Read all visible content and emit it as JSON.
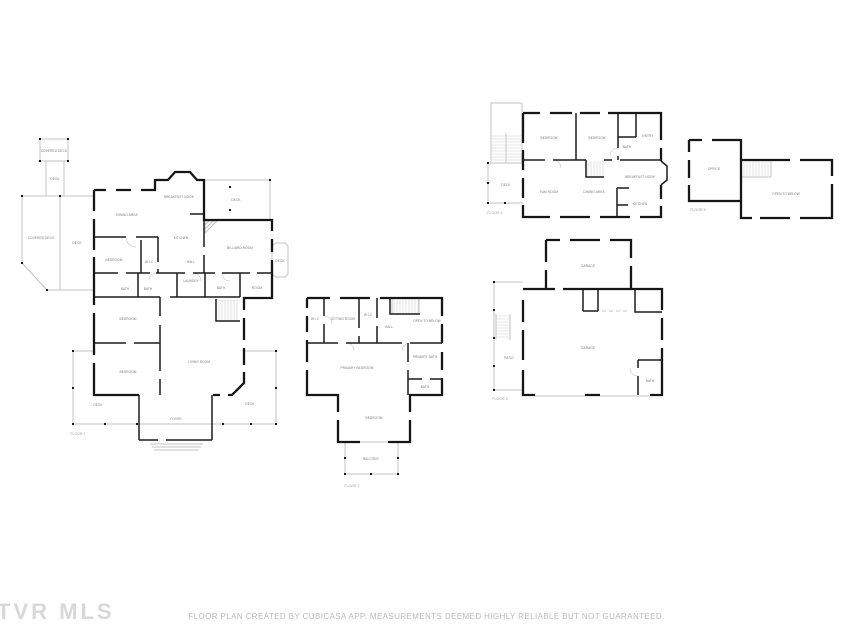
{
  "watermark": {
    "text": "TVR MLS"
  },
  "disclaimer": {
    "text": "FLOOR PLAN CREATED BY CUBICASA APP. MEASUREMENTS DEEMED HIGHLY RELIABLE BUT NOT GUARANTEED."
  },
  "colors": {
    "background": "#ffffff",
    "wall": "#161616",
    "deck_line": "#c3c3c3",
    "room_label": "#787878",
    "floor_label": "#9a9a9a",
    "watermark": "#d8d8d8",
    "disclaimer": "#b9b9b9"
  },
  "floors": [
    {
      "id": "floor-1",
      "title": "FLOOR 1",
      "title_x": 78,
      "title_y": 435,
      "labels": [
        {
          "text": "COVERED DECK",
          "x": 54,
          "y": 152
        },
        {
          "text": "DECK",
          "x": 55,
          "y": 180
        },
        {
          "text": "COVERED DECK",
          "x": 41,
          "y": 239
        },
        {
          "text": "DECK",
          "x": 77,
          "y": 244
        },
        {
          "text": "DINING AREA",
          "x": 127,
          "y": 216
        },
        {
          "text": "BREAKFAST NOOK",
          "x": 179,
          "y": 198
        },
        {
          "text": "DECK",
          "x": 236,
          "y": 201
        },
        {
          "text": "KITCHEN",
          "x": 181,
          "y": 239
        },
        {
          "text": "BILLIARD ROOM",
          "x": 240,
          "y": 249
        },
        {
          "text": "DECK",
          "x": 280,
          "y": 262
        },
        {
          "text": "BEDROOM",
          "x": 114,
          "y": 261
        },
        {
          "text": "W.I.C",
          "x": 149,
          "y": 263
        },
        {
          "text": "HALL",
          "x": 191,
          "y": 263
        },
        {
          "text": "LAUNDRY",
          "x": 191,
          "y": 282
        },
        {
          "text": "BATH",
          "x": 125,
          "y": 290
        },
        {
          "text": "BATH",
          "x": 148,
          "y": 290
        },
        {
          "text": "BATH",
          "x": 221,
          "y": 289
        },
        {
          "text": "ROOM",
          "x": 257,
          "y": 289
        },
        {
          "text": "BEDROOM",
          "x": 128,
          "y": 320
        },
        {
          "text": "LIVING ROOM",
          "x": 199,
          "y": 363
        },
        {
          "text": "BEDROOM",
          "x": 128,
          "y": 373
        },
        {
          "text": "DECK",
          "x": 98,
          "y": 406
        },
        {
          "text": "DECK",
          "x": 250,
          "y": 405
        },
        {
          "text": "FOYER",
          "x": 176,
          "y": 420
        }
      ]
    },
    {
      "id": "floor-2",
      "title": "FLOOR 2",
      "title_x": 352,
      "title_y": 487,
      "labels": [
        {
          "text": "W.I.C",
          "x": 315,
          "y": 320
        },
        {
          "text": "SITTING ROOM",
          "x": 343,
          "y": 320
        },
        {
          "text": "W.I.C",
          "x": 368,
          "y": 316
        },
        {
          "text": "HALL",
          "x": 389,
          "y": 328
        },
        {
          "text": "OPEN TO BELOW",
          "x": 427,
          "y": 322
        },
        {
          "text": "PRIMARY BATH",
          "x": 425,
          "y": 358
        },
        {
          "text": "PRIMARY BEDROOM",
          "x": 357,
          "y": 369
        },
        {
          "text": "BATH",
          "x": 425,
          "y": 388
        },
        {
          "text": "BEDROOM",
          "x": 374,
          "y": 419
        },
        {
          "text": "BALCONY",
          "x": 371,
          "y": 460
        }
      ]
    },
    {
      "id": "floor-3",
      "title": "FLOOR 3",
      "title_x": 500,
      "title_y": 400,
      "labels": [
        {
          "text": "GARAGE",
          "x": 588,
          "y": 267
        },
        {
          "text": "GARAGE",
          "x": 588,
          "y": 349
        },
        {
          "text": "PATIO",
          "x": 509,
          "y": 359
        },
        {
          "text": "BATH",
          "x": 650,
          "y": 382
        }
      ]
    },
    {
      "id": "floor-4",
      "title": "FLOOR 4",
      "title_x": 495,
      "title_y": 214,
      "labels": [
        {
          "text": "BEDROOM",
          "x": 549,
          "y": 139
        },
        {
          "text": "BEDROOM",
          "x": 597,
          "y": 139
        },
        {
          "text": "BATH",
          "x": 627,
          "y": 148
        },
        {
          "text": "ENTRY",
          "x": 648,
          "y": 137
        },
        {
          "text": "DECK",
          "x": 506,
          "y": 186
        },
        {
          "text": "FAM ROOM",
          "x": 549,
          "y": 193
        },
        {
          "text": "DINING AREA",
          "x": 594,
          "y": 193
        },
        {
          "text": "BREAKFAST NOOK",
          "x": 640,
          "y": 178
        },
        {
          "text": "KITCHEN",
          "x": 640,
          "y": 205
        }
      ]
    },
    {
      "id": "floor-5",
      "title": "FLOOR 5",
      "title_x": 698,
      "title_y": 211,
      "labels": [
        {
          "text": "OFFICE",
          "x": 714,
          "y": 170
        },
        {
          "text": "OPEN TO BELOW",
          "x": 786,
          "y": 195
        }
      ]
    }
  ]
}
